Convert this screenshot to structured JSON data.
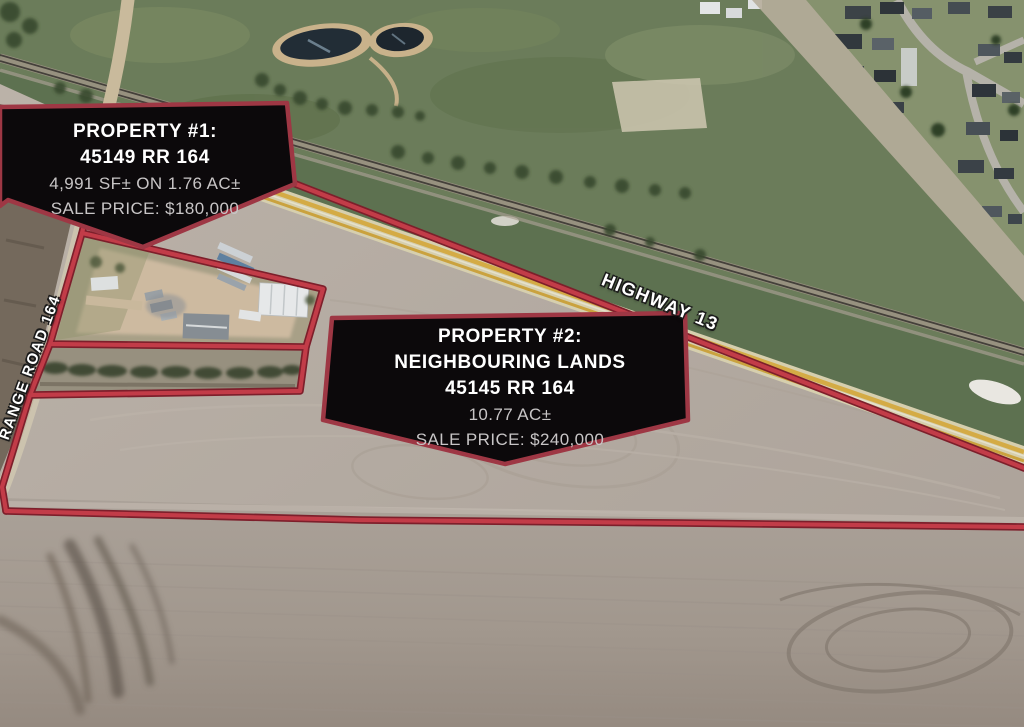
{
  "callouts": {
    "property1": {
      "title": "PROPERTY #1:",
      "address": "45149 RR 164",
      "size": "4,991 SF± ON 1.76 AC±",
      "price": "SALE PRICE: $180,000"
    },
    "property2": {
      "title": "PROPERTY #2:",
      "subtitle": "NEIGHBOURING LANDS",
      "address": "45145 RR 164",
      "size": "10.77 AC±",
      "price": "SALE PRICE: $240,000"
    }
  },
  "road_labels": {
    "highway": "HIGHWAY 13",
    "range_road": "RANGE ROAD 164"
  },
  "colors": {
    "boundary_red": "#c23c48",
    "boundary_edge": "#7d1f2b",
    "callout_background": "#0c090b",
    "callout_border": "#9e3744",
    "title_text": "#ffffff",
    "detail_text": "#c8c5c6"
  }
}
